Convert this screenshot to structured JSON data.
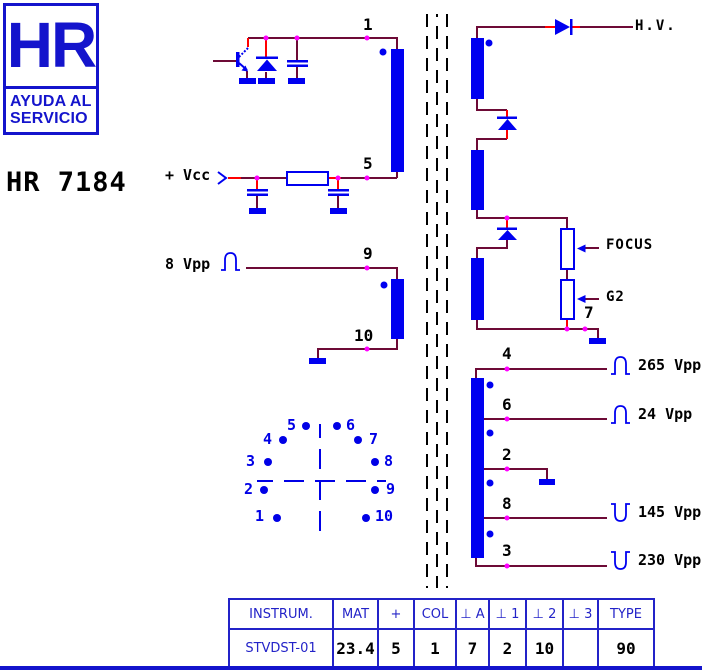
{
  "logo": {
    "hr": "HR",
    "line1": "AYUDA AL",
    "line2": "SERVICIO"
  },
  "title": "HR 7184",
  "labels": {
    "vcc": "+ Vcc",
    "vpp8": "8 Vpp",
    "hv": "H.V.",
    "focus": "FOCUS",
    "g2": "G2",
    "vpp265": "265 Vpp",
    "vpp24": "24 Vpp",
    "vpp145": "145 Vpp",
    "vpp230": "230 Vpp"
  },
  "pins": {
    "p1": "1",
    "p2": "2",
    "p3": "3",
    "p4": "4",
    "p5": "5",
    "p6": "6",
    "p7": "7",
    "p8": "8",
    "p9": "9",
    "p10": "10"
  },
  "pinout": {
    "labels": [
      "1",
      "2",
      "3",
      "4",
      "5",
      "6",
      "7",
      "8",
      "9",
      "10"
    ]
  },
  "table": {
    "headers": [
      "INSTRUM.",
      "MAT",
      "+",
      "COL",
      "⊥ A",
      "⊥ 1",
      "⊥ 2",
      "⊥ 3",
      "TYPE"
    ],
    "values": [
      "STVDST-01",
      "23.4",
      "5",
      "1",
      "7",
      "2",
      "10",
      "",
      "90"
    ]
  },
  "colors": {
    "component_blue": "#0000f0",
    "wire_maroon": "#6d0a36",
    "wire_red": "#ff0000",
    "junction_magenta": "#ff00ff",
    "logo_blue": "#1414cc"
  }
}
